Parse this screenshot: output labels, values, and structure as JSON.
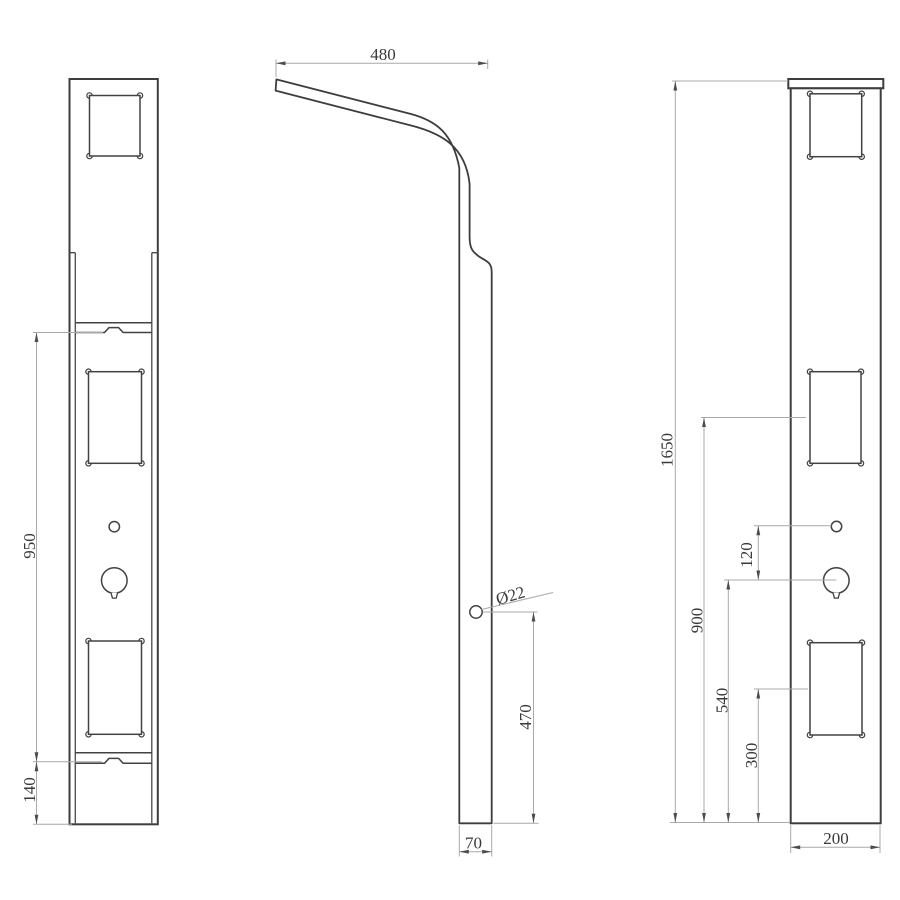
{
  "drawing": {
    "background": "#ffffff",
    "object_line_color": "#3d3d3d",
    "dimension_line_color": "#a9a9a9",
    "text_color": "#3a3a3a",
    "views": {
      "front": {
        "dims": {
          "d950": "950",
          "d140": "140"
        }
      },
      "side": {
        "dims": {
          "d480": "480",
          "dia": "Ø22",
          "d470": "470",
          "d70": "70"
        }
      },
      "back": {
        "dims": {
          "d1650": "1650",
          "d120": "120",
          "d900": "900",
          "d540": "540",
          "d300": "300",
          "d200": "200"
        }
      }
    }
  }
}
